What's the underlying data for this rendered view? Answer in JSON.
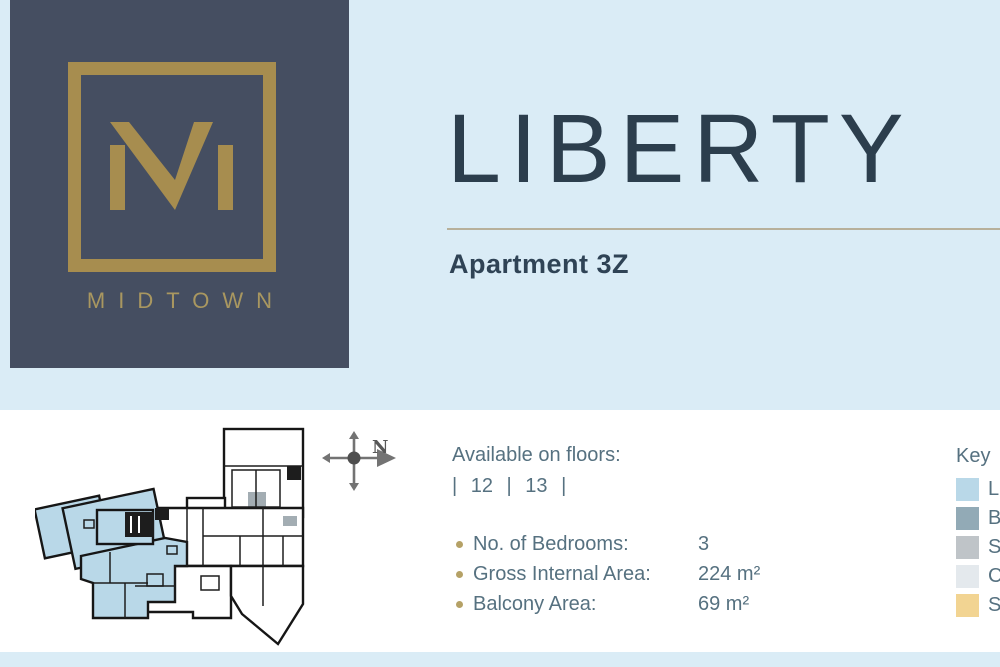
{
  "brand": {
    "name": "MIDTOWN",
    "monogram": "M"
  },
  "apartment": {
    "name": "LIBERTY",
    "unit": "Apartment 3Z"
  },
  "availability": {
    "label": "Available on floors:",
    "floors": "| 12 | 13 |"
  },
  "details": {
    "rows": [
      {
        "label": "No. of Bedrooms:",
        "value": "3"
      },
      {
        "label": "Gross Internal Area:",
        "value": "224 m²"
      },
      {
        "label": "Balcony Area:",
        "value": "69 m²"
      }
    ]
  },
  "key": {
    "title": "Key",
    "items": [
      {
        "label": "L",
        "color": "#b9d8e8"
      },
      {
        "label": "B",
        "color": "#92aab6"
      },
      {
        "label": "S",
        "color": "#bfc4c8"
      },
      {
        "label": "C",
        "color": "#e4e9ed"
      },
      {
        "label": "S",
        "color": "#f2d492"
      }
    ]
  },
  "compass": {
    "north": "N"
  },
  "colors": {
    "header_bg": "#daecf6",
    "logo_bg": "#454e61",
    "gold": "#a78d4f",
    "title_text": "#2c3e4d",
    "body_text": "#567180",
    "bullet": "#b5a166",
    "divider": "#b7b09b",
    "plan_highlight": "#b9d8e8"
  }
}
